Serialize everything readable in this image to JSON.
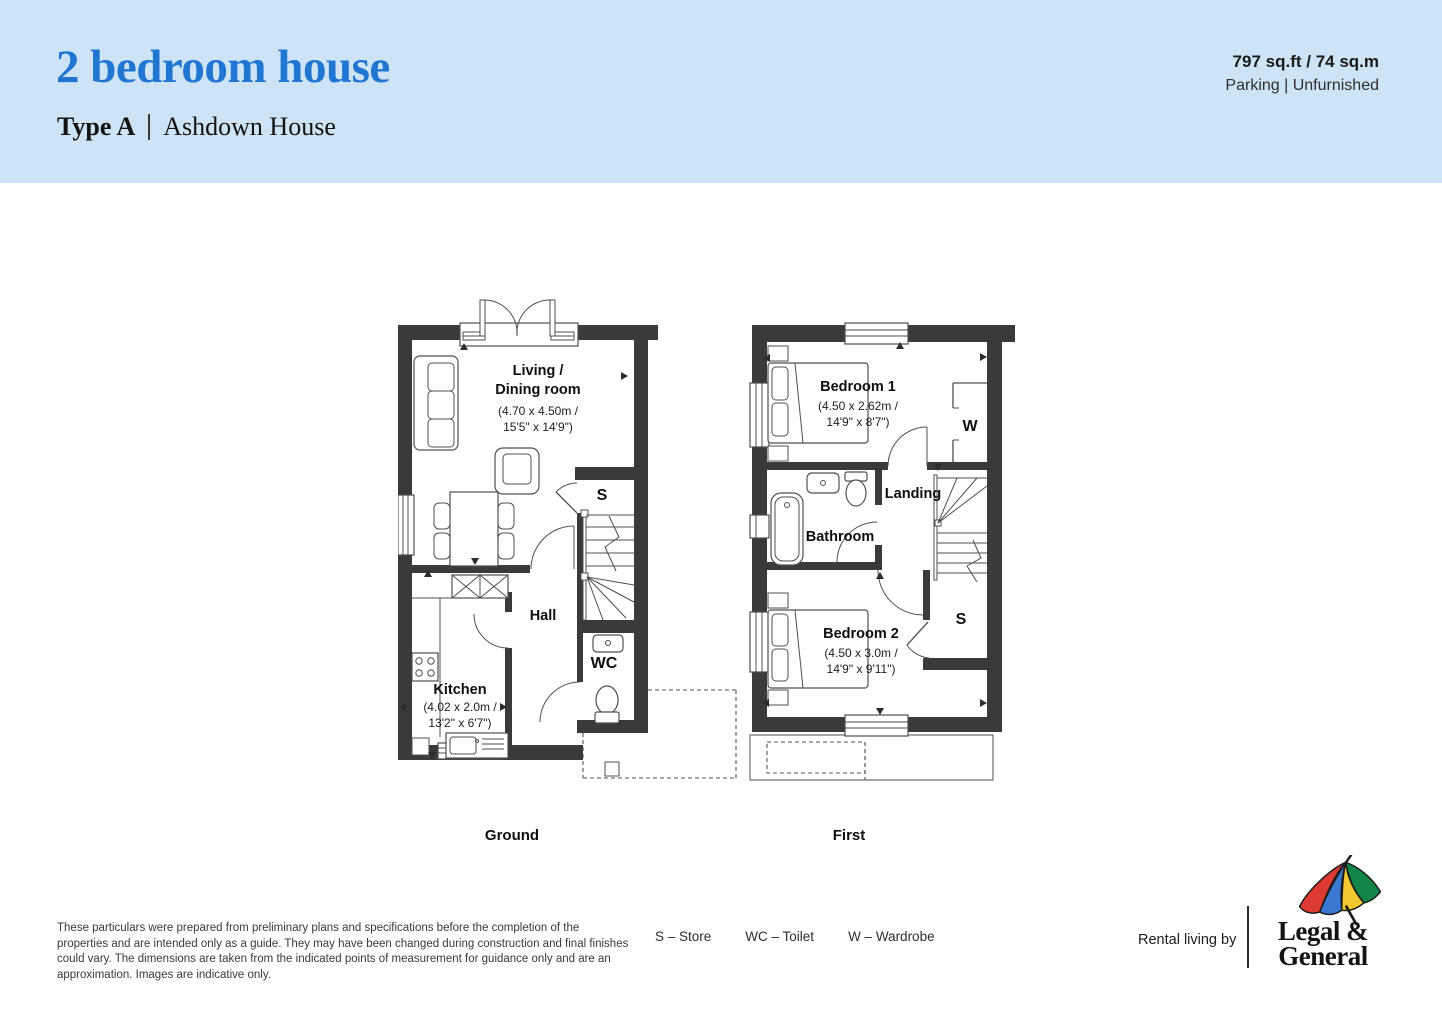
{
  "header": {
    "title": "2 bedroom house",
    "type_label": "Type A",
    "house_name": "Ashdown House",
    "area": "797 sq.ft / 74 sq.m",
    "features": "Parking  |  Unfurnished"
  },
  "plans": {
    "ground": {
      "floor_label": "Ground",
      "living": {
        "name_line1": "Living /",
        "name_line2": "Dining room",
        "dims_line1": "(4.70 x 4.50m /",
        "dims_line2": "15'5\" x 14'9\")"
      },
      "kitchen": {
        "name": "Kitchen",
        "dims_line1": "(4.02 x 2.0m /",
        "dims_line2": "13'2\" x 6'7\")"
      },
      "hall": "Hall",
      "wc": "WC",
      "store": "S"
    },
    "first": {
      "floor_label": "First",
      "bedroom1": {
        "name": "Bedroom 1",
        "dims_line1": "(4.50 x 2.62m /",
        "dims_line2": "14'9\" x 8'7\")"
      },
      "bedroom2": {
        "name": "Bedroom 2",
        "dims_line1": "(4.50 x 3.0m /",
        "dims_line2": "14'9\" x 9'11\")"
      },
      "bathroom": "Bathroom",
      "landing": "Landing",
      "wardrobe": "W",
      "store": "S"
    }
  },
  "footer": {
    "disclaimer": "These particulars were prepared from preliminary plans and specifications before the completion of the properties and are intended only as a guide. They may have been changed during construction and final finishes could vary. The dimensions are taken from the indicated points of measurement for guidance only and are an approximation. Images are indicative only.",
    "legend": [
      {
        "label": "S – Store"
      },
      {
        "label": "WC – Toilet"
      },
      {
        "label": "W – Wardrobe"
      }
    ],
    "rental_by": "Rental living by",
    "logo_line1": "Legal &",
    "logo_line2": "General"
  },
  "colors": {
    "header_bg": "#cde4f6",
    "title_blue": "#2176d2",
    "wall": "#3a3a3a",
    "umbrella_red": "#dd3a34",
    "umbrella_blue": "#3a78d2",
    "umbrella_yellow": "#f3c92f",
    "umbrella_green": "#13854b"
  }
}
